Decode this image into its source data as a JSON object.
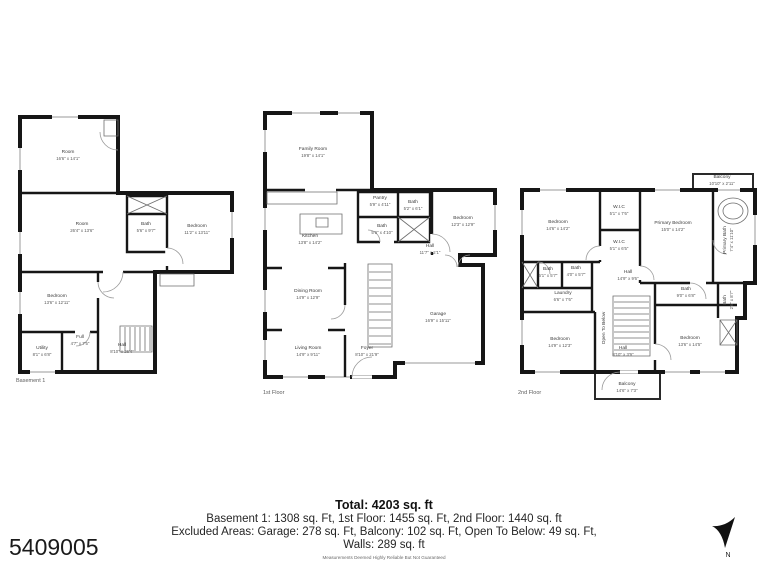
{
  "page": {
    "photo_id": "5409005",
    "background": "#ffffff",
    "wall_color": "#161616"
  },
  "compass": {
    "label": "N"
  },
  "floors": [
    {
      "label": "Basement 1",
      "rooms": [
        {
          "name": "Room",
          "dims": "16'6\" x 14'1\""
        },
        {
          "name": "Room",
          "dims": "26'4\" x 13'6\""
        },
        {
          "name": "Bath",
          "dims": "5'6\" x 9'7\""
        },
        {
          "name": "Bedroom",
          "dims": "11'2\" x 13'11\""
        },
        {
          "name": "Bedroom",
          "dims": "13'6\" x 12'11\""
        },
        {
          "name": "Utility",
          "dims": "8'1\" x 6'8\""
        },
        {
          "name": "Full",
          "dims": "4'7\" x 7'5\""
        },
        {
          "name": "Hall",
          "dims": "8'10\" x 26'4\""
        }
      ]
    },
    {
      "label": "1st Floor",
      "rooms": [
        {
          "name": "Family Room",
          "dims": "19'8\" x 14'1\""
        },
        {
          "name": "Pantry",
          "dims": "5'9\" x 4'11\""
        },
        {
          "name": "Bath",
          "dims": "5'2\" x 6'1\""
        },
        {
          "name": "Bedroom",
          "dims": "12'3\" x 12'9\""
        },
        {
          "name": "Kitchen",
          "dims": "13'8\" x 14'2\""
        },
        {
          "name": "Bath",
          "dims": "5'9\" x 4'10\""
        },
        {
          "name": "Hall",
          "dims": "11'7\" x 2'1\""
        },
        {
          "name": "Dining Room",
          "dims": "14'9\" x 12'9\""
        },
        {
          "name": "Living Room",
          "dims": "14'9\" x 9'11\""
        },
        {
          "name": "Foyer",
          "dims": "8'10\" x 21'9\""
        },
        {
          "name": "Garage",
          "dims": "16'9\" x 15'11\""
        }
      ]
    },
    {
      "label": "2nd Floor",
      "rooms": [
        {
          "name": "Balcony",
          "dims": "10'10\" x 2'11\""
        },
        {
          "name": "Bedroom",
          "dims": "14'6\" x 14'2\""
        },
        {
          "name": "W.I.C",
          "dims": "5'1\" x 7'6\""
        },
        {
          "name": "W.I.C",
          "dims": "5'1\" x 6'5\""
        },
        {
          "name": "Primary Bedroom",
          "dims": "15'0\" x 14'2\""
        },
        {
          "name": "Primary Bath",
          "dims": "7'4\" x 11'10\""
        },
        {
          "name": "Bath",
          "dims": "5'1\" x 5'7\""
        },
        {
          "name": "Bath",
          "dims": "4'0\" x 5'7\""
        },
        {
          "name": "Hall",
          "dims": "14'9\" x 9'6\""
        },
        {
          "name": "Laundry",
          "dims": "6'6\" x 7'6\""
        },
        {
          "name": "Bedroom",
          "dims": "14'9\" x 12'3\""
        },
        {
          "name": "Open To Below",
          "dims": ""
        },
        {
          "name": "Hall",
          "dims": "8'10\" x 3'9\""
        },
        {
          "name": "Bedroom",
          "dims": "13'6\" x 14'5\""
        },
        {
          "name": "Bath",
          "dims": "9'0\" x 6'8\""
        },
        {
          "name": "Bath",
          "dims": "2'6\" x 8'7\""
        },
        {
          "name": "Balcony",
          "dims": "14'6\" x 7'3\""
        }
      ]
    }
  ],
  "summary": {
    "total": "Total: 4203 sq. ft",
    "line1": "Basement 1: 1308 sq. Ft, 1st Floor: 1455 sq. Ft, 2nd Floor: 1440 sq. ft",
    "line2": "Excluded Areas: Garage: 278 sq. Ft, Balcony: 102 sq. Ft, Open To Below: 49 sq. Ft,",
    "line3": "Walls: 289 sq. ft",
    "disclaimer": "Measurements Deemed Highly Reliable But Not Guaranteed"
  }
}
